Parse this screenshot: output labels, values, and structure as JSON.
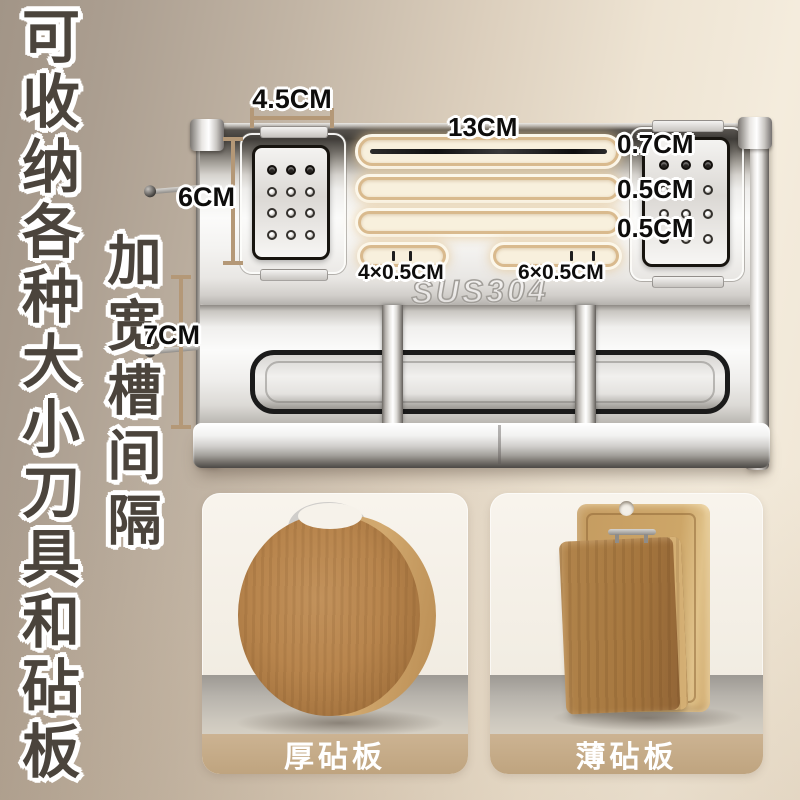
{
  "headline": {
    "text": "可收纳各种大小刀具和砧板"
  },
  "subheadline": {
    "text": "加宽槽间隔"
  },
  "product": {
    "material_label": "SUS304",
    "dimensions": {
      "top_width": "4.5CM",
      "long_slot": "13CM",
      "left_height": "6CM",
      "right_slot_top": "0.7CM",
      "right_slot_mid": "0.5CM",
      "right_slot_bottom": "0.5CM",
      "lower_height": "7CM",
      "small_slot_left": "4×0.5CM",
      "small_slot_right": "6×0.5CM"
    }
  },
  "cards": [
    {
      "label": "厚砧板"
    },
    {
      "label": "薄砧板"
    }
  ],
  "colors": {
    "accent_tan": "#b49877",
    "slot_glow": "#e4c694",
    "card_label_bar": "#c5a87f",
    "headline_text": "#4b443c",
    "background_left": "#a29587",
    "background_right": "#f4ecdd"
  }
}
